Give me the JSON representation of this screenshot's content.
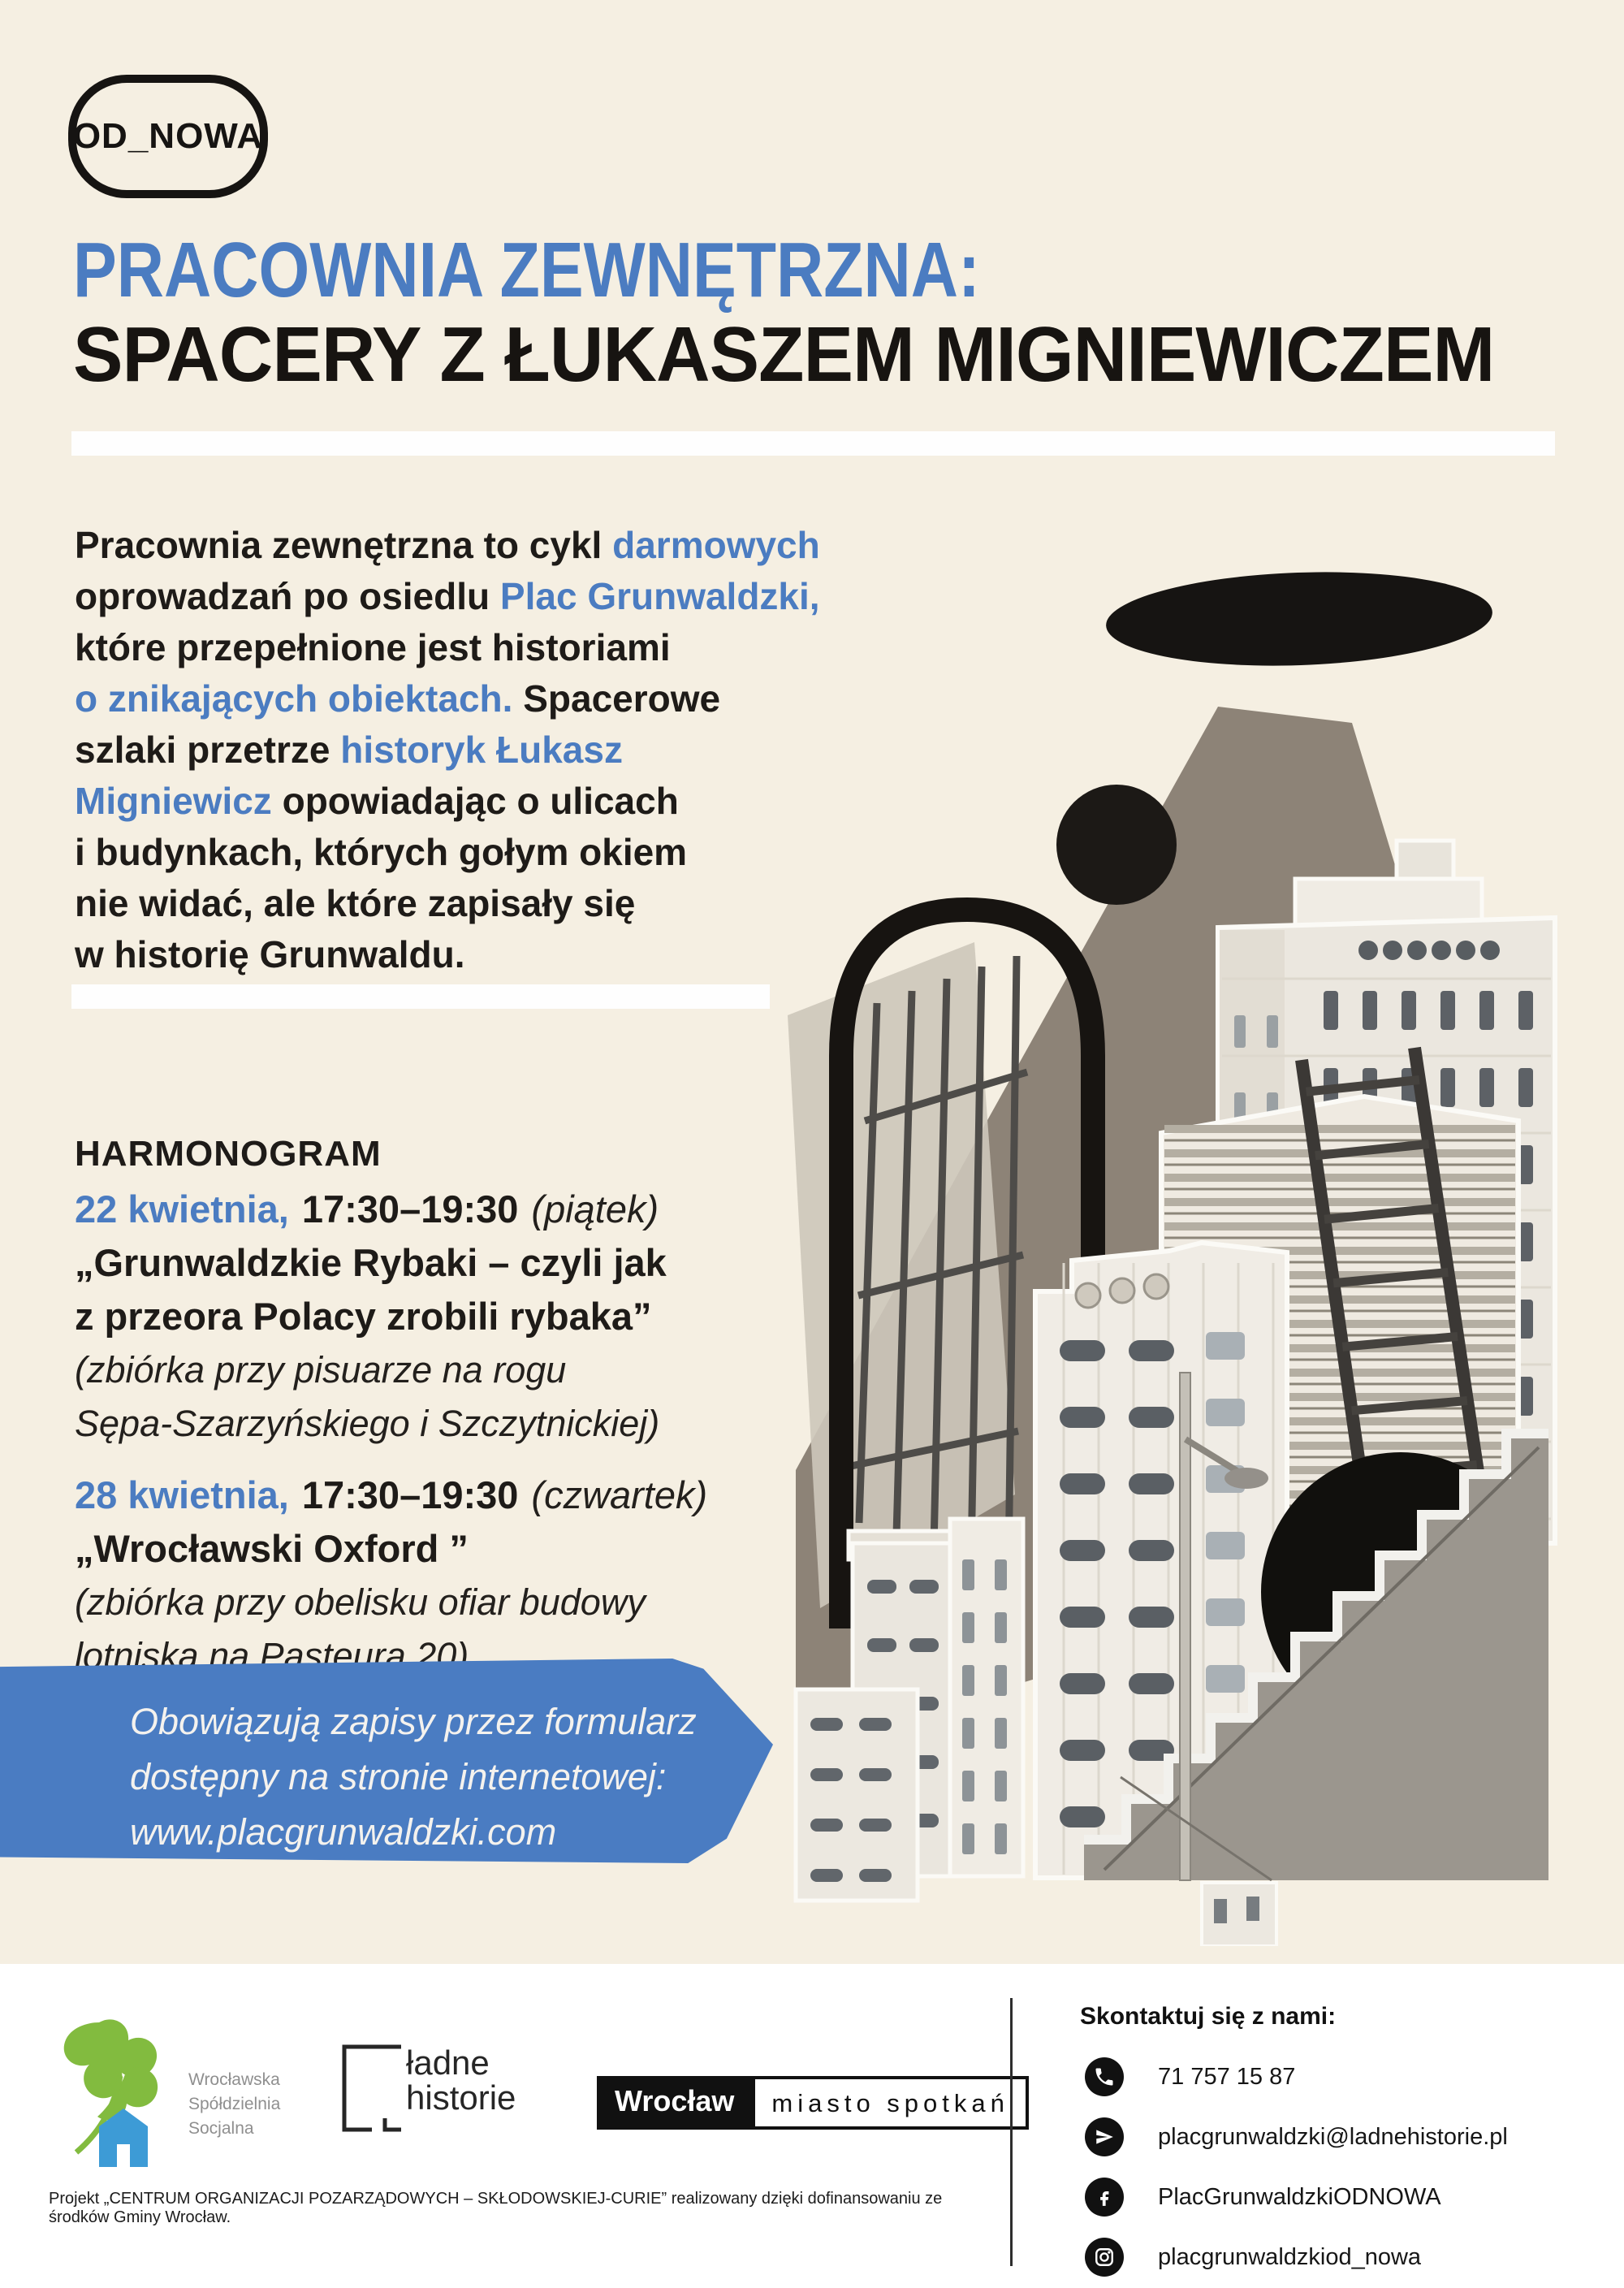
{
  "palette": {
    "bg": "#f5efe2",
    "accent": "#4b7cc1",
    "ink": "#1e1b18",
    "banner": "#4a7cc2",
    "beam": "#8d8377",
    "white": "#fefefe"
  },
  "badge": {
    "label": "OD_NOWA"
  },
  "title": {
    "line1": "PRACOWNIA ZEWNĘTRZNA:",
    "line2": "SPACERY Z ŁUKASZEM MIGNIEWICZEM"
  },
  "intro": {
    "lines": [
      [
        {
          "t": "Pracownia zewnętrzna to cykl ",
          "c": "black"
        },
        {
          "t": "darmowych",
          "c": "blue"
        }
      ],
      [
        {
          "t": "oprowadzań po osiedlu ",
          "c": "black"
        },
        {
          "t": "Plac Grunwaldzki,",
          "c": "blue"
        }
      ],
      [
        {
          "t": "które przepełnione jest historiami",
          "c": "black"
        }
      ],
      [
        {
          "t": "o znikających obiektach.",
          "c": "blue"
        },
        {
          "t": " Spacerowe",
          "c": "black"
        }
      ],
      [
        {
          "t": "szlaki przetrze ",
          "c": "black"
        },
        {
          "t": "historyk Łukasz",
          "c": "blue"
        }
      ],
      [
        {
          "t": "Migniewicz",
          "c": "blue"
        },
        {
          "t": " opowiadając o ulicach",
          "c": "black"
        }
      ],
      [
        {
          "t": "i budynkach, których gołym okiem",
          "c": "black"
        }
      ],
      [
        {
          "t": "nie widać, ale które zapisały się",
          "c": "black"
        }
      ],
      [
        {
          "t": "w historię Grunwaldu.",
          "c": "black"
        }
      ]
    ]
  },
  "schedule": {
    "heading": "HARMONOGRAM",
    "events": [
      {
        "date": "22 kwietnia,",
        "time": "17:30–19:30",
        "day": "(piątek)",
        "title_lines": [
          "„Grunwaldzkie Rybaki – czyli jak",
          "z przeora Polacy zrobili rybaka”"
        ],
        "note_lines": [
          "(zbiórka przy pisuarze na rogu",
          "Sępa-Szarzyńskiego i Szczytnickiej)"
        ]
      },
      {
        "date": "28 kwietnia,",
        "time": "17:30–19:30",
        "day": "(czwartek)",
        "title_lines": [
          "„Wrocławski Oxford ”"
        ],
        "note_lines": [
          "(zbiórka przy obelisku ofiar budowy",
          "lotniska na Pasteura 20)"
        ]
      }
    ]
  },
  "banner": {
    "lines": [
      "Obowiązują zapisy przez formularz",
      "dostępny na stronie internetowej:",
      "www.placgrunwaldzki.com"
    ]
  },
  "collage": {
    "description": "Black-and-white collage of Plac Grunwaldzki modernist towers with black ellipse, beam, arch outline, ladder, street lamp and staircase"
  },
  "footer": {
    "partners": {
      "wss_lines": [
        "Wrocławska",
        "Spółdzielnia",
        "Socjalna"
      ],
      "ladne_line1": "ładne",
      "ladne_line2": "historie",
      "wroclaw": "Wrocław",
      "wroclaw_tagline": "miasto spotkań"
    },
    "contact": {
      "heading": "Skontaktuj się z nami:",
      "items": [
        {
          "icon": "phone-icon",
          "value": "71 757 15 87"
        },
        {
          "icon": "telegram-icon",
          "value": "placgrunwaldzki@ladnehistorie.pl"
        },
        {
          "icon": "facebook-icon",
          "value": "PlacGrunwaldzkiODNOWA"
        },
        {
          "icon": "instagram-icon",
          "value": "placgrunwaldzkiod_nowa"
        }
      ]
    },
    "funding_note": "Projekt „CENTRUM ORGANIZACJI POZARZĄDOWYCH – SKŁODOWSKIEJ-CURIE” realizowany dzięki dofinansowaniu ze środków Gminy Wrocław."
  }
}
